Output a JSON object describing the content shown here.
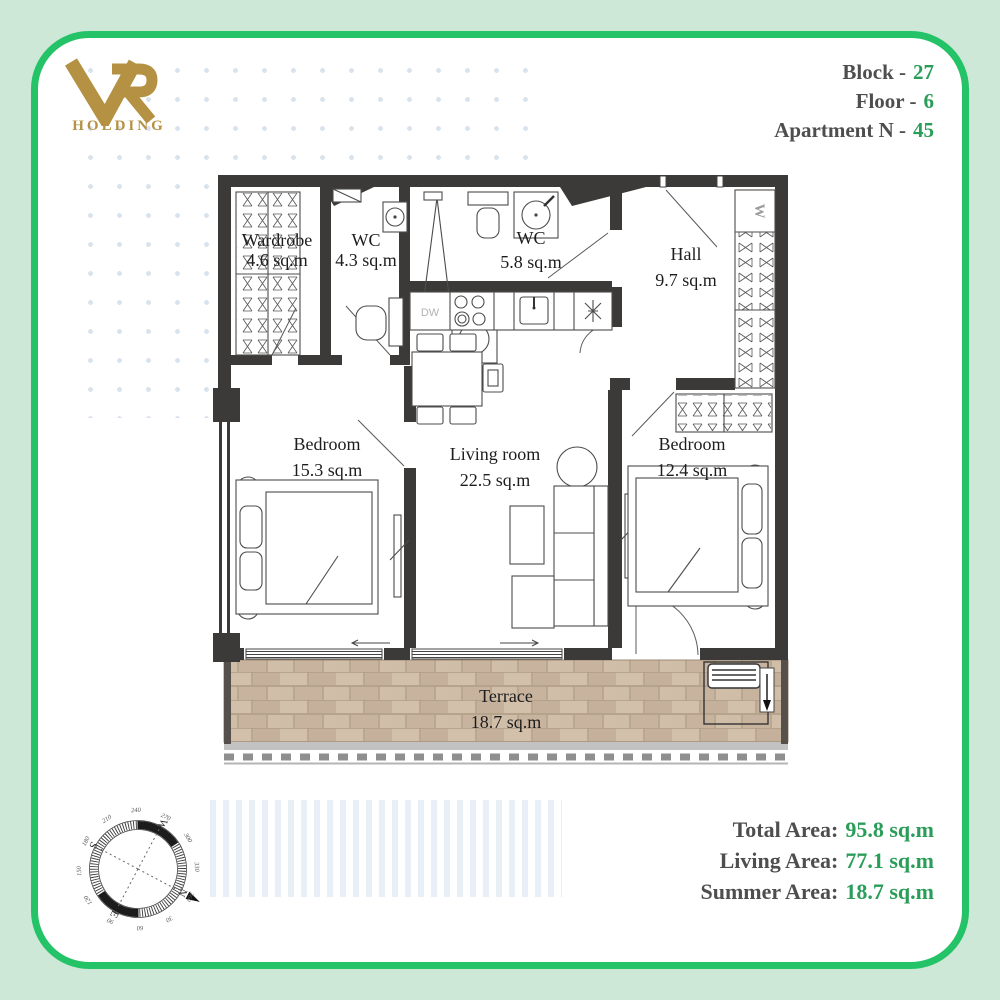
{
  "brand": {
    "monogram": "VR",
    "name": "HOLDING"
  },
  "header": {
    "lines": [
      {
        "label": "Block -",
        "value": "27"
      },
      {
        "label": "Floor -",
        "value": "6"
      },
      {
        "label": "Apartment N -",
        "value": "45"
      }
    ]
  },
  "rooms": [
    {
      "name": "Wardrobe",
      "area": "4.6 sq.m"
    },
    {
      "name": "WC",
      "area": "4.3 sq.m"
    },
    {
      "name": "WC",
      "area": "5.8 sq.m"
    },
    {
      "name": "Hall",
      "area": "9.7 sq.m"
    },
    {
      "name": "Bedroom",
      "area": "15.3 sq.m"
    },
    {
      "name": "Living room",
      "area": "22.5 sq.m"
    },
    {
      "name": "Bedroom",
      "area": "12.4 sq.m"
    },
    {
      "name": "Terrace",
      "area": "18.7 sq.m"
    }
  ],
  "plan_markers": {
    "dishwasher": "DW",
    "wardrobe": "W"
  },
  "summary": {
    "lines": [
      {
        "label": "Total Area:",
        "value": "95.8 sq.m"
      },
      {
        "label": "Living Area:",
        "value": "77.1 sq.m"
      },
      {
        "label": "Summer Area:",
        "value": "18.7 sq.m"
      }
    ]
  },
  "compass": {
    "north": "N",
    "east": "E",
    "south": "S",
    "west": "W",
    "degrees": [
      "30",
      "60",
      "90",
      "120",
      "150",
      "180",
      "210",
      "240",
      "270",
      "300",
      "330",
      "360"
    ]
  },
  "colors": {
    "frame_bg": "#cde8d7",
    "frame_border": "#25c368",
    "value_green": "#2a9d58",
    "label_gray": "#4e4e4e",
    "logo_gold": "#b49143",
    "wall": "#3b3a38",
    "terrace_tile": "#cbb8a2"
  }
}
